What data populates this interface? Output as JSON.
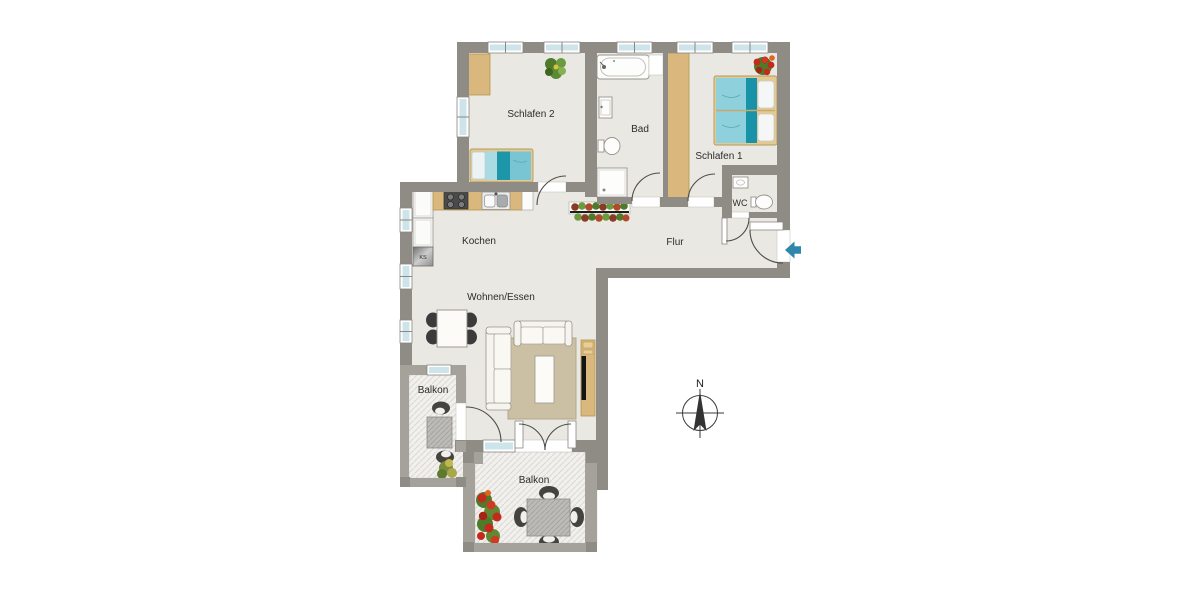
{
  "rooms": {
    "schlafen2": "Schlafen 2",
    "bad": "Bad",
    "schlafen1": "Schlafen 1",
    "wc": "WC",
    "kochen": "Kochen",
    "flur": "Flur",
    "wohnen_essen": "Wohnen/Essen",
    "balkon_west": "Balkon",
    "balkon_sued": "Balkon"
  },
  "labels": {
    "fridge": "KS",
    "compass_north": "N"
  },
  "colors": {
    "wall": "#8f8b85",
    "balcony_wall": "#a5a29b",
    "floor": "#eae8e3",
    "window_glass": "#cde4ea",
    "wood_furniture": "#dab87d",
    "bed_teal_dark": "#1e96aa",
    "bed_teal_light": "#84cad7",
    "rug": "#cbc0a4",
    "entry_arrow": "#2e86ab",
    "flower_red": "#c32a1c",
    "plant_green": "#6a9c3f"
  }
}
